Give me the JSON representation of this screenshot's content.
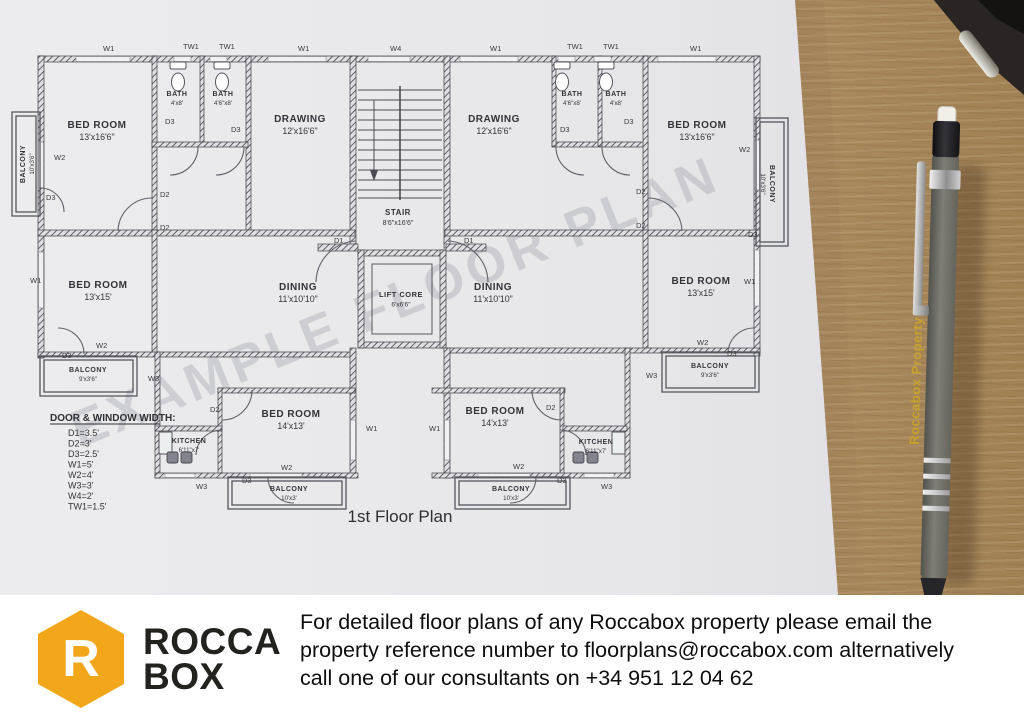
{
  "photo": {
    "watermark": "EXAMPLE FLOOR PLAN",
    "pen_text": "Roccabox Property"
  },
  "plan": {
    "title": "1st Floor Plan",
    "legend": {
      "heading": "DOOR & WINDOW WIDTH:",
      "items": [
        "D1=3.5'",
        "D2=3'",
        "D3=2.5'",
        "W1=5'",
        "W2=4'",
        "W3=3'",
        "W4=2'",
        "TW1=1.5'"
      ]
    },
    "rooms": [
      {
        "name": "BED ROOM",
        "dims": "13'x16'6\"",
        "x": 97,
        "y": 128,
        "fs": 10
      },
      {
        "name": "BATH",
        "dims": "4'x8'",
        "x": 177,
        "y": 96,
        "fs": 7
      },
      {
        "name": "BATH",
        "dims": "4'6\"x8'",
        "x": 223,
        "y": 96,
        "fs": 7
      },
      {
        "name": "DRAWING",
        "dims": "12'x16'6\"",
        "x": 300,
        "y": 122,
        "fs": 10
      },
      {
        "name": "STAIR",
        "dims": "8'6\"x16'6\"",
        "x": 398,
        "y": 215,
        "fs": 8
      },
      {
        "name": "DRAWING",
        "dims": "12'x16'6\"",
        "x": 494,
        "y": 122,
        "fs": 10
      },
      {
        "name": "BATH",
        "dims": "4'6\"x8'",
        "x": 572,
        "y": 96,
        "fs": 7
      },
      {
        "name": "BATH",
        "dims": "4'x8'",
        "x": 616,
        "y": 96,
        "fs": 7
      },
      {
        "name": "BED ROOM",
        "dims": "13'x16'6\"",
        "x": 697,
        "y": 128,
        "fs": 10
      },
      {
        "name": "BALCONY",
        "dims": "10'x3'6\"",
        "x": 25,
        "y": 164,
        "fs": 7,
        "rot": -90
      },
      {
        "name": "BALCONY",
        "dims": "10'x3'6\"",
        "x": 770,
        "y": 184,
        "fs": 7,
        "rot": 90
      },
      {
        "name": "BED ROOM",
        "dims": "13'x15'",
        "x": 98,
        "y": 288,
        "fs": 10
      },
      {
        "name": "DINING",
        "dims": "11'x10'10\"",
        "x": 298,
        "y": 290,
        "fs": 10
      },
      {
        "name": "LIFT CORE",
        "dims": "6'x6'6\"",
        "x": 401,
        "y": 297,
        "fs": 7.5
      },
      {
        "name": "DINING",
        "dims": "11'x10'10\"",
        "x": 493,
        "y": 290,
        "fs": 10
      },
      {
        "name": "BED ROOM",
        "dims": "13'x15'",
        "x": 701,
        "y": 284,
        "fs": 10
      },
      {
        "name": "BALCONY",
        "dims": "9'x3'6\"",
        "x": 88,
        "y": 372,
        "fs": 7
      },
      {
        "name": "BALCONY",
        "dims": "9'x3'6\"",
        "x": 710,
        "y": 368,
        "fs": 7
      },
      {
        "name": "KITCHEN",
        "dims": "6'11\"x7'",
        "x": 189,
        "y": 443,
        "fs": 7
      },
      {
        "name": "BED ROOM",
        "dims": "14'x13'",
        "x": 291,
        "y": 417,
        "fs": 10
      },
      {
        "name": "BED ROOM",
        "dims": "14'x13'",
        "x": 495,
        "y": 414,
        "fs": 10
      },
      {
        "name": "KITCHEN",
        "dims": "6'11\"x7'",
        "x": 596,
        "y": 444,
        "fs": 7
      },
      {
        "name": "BALCONY",
        "dims": "10'x3'",
        "x": 289,
        "y": 491,
        "fs": 7
      },
      {
        "name": "BALCONY",
        "dims": "10'x3'",
        "x": 511,
        "y": 491,
        "fs": 7
      }
    ],
    "wall_tags": [
      {
        "t": "W1",
        "x": 103,
        "y": 51
      },
      {
        "t": "TW1",
        "x": 183,
        "y": 49
      },
      {
        "t": "TW1",
        "x": 219,
        "y": 49
      },
      {
        "t": "W1",
        "x": 298,
        "y": 51
      },
      {
        "t": "W4",
        "x": 390,
        "y": 51
      },
      {
        "t": "W1",
        "x": 490,
        "y": 51
      },
      {
        "t": "TW1",
        "x": 567,
        "y": 49
      },
      {
        "t": "TW1",
        "x": 603,
        "y": 49
      },
      {
        "t": "W1",
        "x": 690,
        "y": 51
      },
      {
        "t": "W2",
        "x": 54,
        "y": 160
      },
      {
        "t": "D3",
        "x": 46,
        "y": 200
      },
      {
        "t": "W1",
        "x": 30,
        "y": 283
      },
      {
        "t": "W2",
        "x": 739,
        "y": 152
      },
      {
        "t": "D3",
        "x": 748,
        "y": 237
      },
      {
        "t": "W1",
        "x": 744,
        "y": 284
      },
      {
        "t": "D3",
        "x": 165,
        "y": 124
      },
      {
        "t": "D3",
        "x": 231,
        "y": 132
      },
      {
        "t": "D3",
        "x": 560,
        "y": 132
      },
      {
        "t": "D3",
        "x": 624,
        "y": 124
      },
      {
        "t": "D2",
        "x": 160,
        "y": 197
      },
      {
        "t": "D2",
        "x": 160,
        "y": 230
      },
      {
        "t": "D2",
        "x": 636,
        "y": 194
      },
      {
        "t": "D2",
        "x": 636,
        "y": 228
      },
      {
        "t": "D1",
        "x": 334,
        "y": 243
      },
      {
        "t": "D1",
        "x": 464,
        "y": 243
      },
      {
        "t": "W2",
        "x": 96,
        "y": 348
      },
      {
        "t": "D3",
        "x": 62,
        "y": 358
      },
      {
        "t": "W3",
        "x": 148,
        "y": 381
      },
      {
        "t": "W2",
        "x": 697,
        "y": 345
      },
      {
        "t": "D3",
        "x": 727,
        "y": 356
      },
      {
        "t": "W3",
        "x": 646,
        "y": 378
      },
      {
        "t": "D2",
        "x": 210,
        "y": 412
      },
      {
        "t": "D2",
        "x": 546,
        "y": 410
      },
      {
        "t": "W1",
        "x": 366,
        "y": 431
      },
      {
        "t": "W1",
        "x": 429,
        "y": 431
      },
      {
        "t": "W2",
        "x": 281,
        "y": 470
      },
      {
        "t": "D3",
        "x": 242,
        "y": 483
      },
      {
        "t": "W3",
        "x": 196,
        "y": 489
      },
      {
        "t": "W2",
        "x": 513,
        "y": 469
      },
      {
        "t": "D3",
        "x": 557,
        "y": 483
      },
      {
        "t": "W3",
        "x": 601,
        "y": 489
      }
    ]
  },
  "footer": {
    "logo_letter": "R",
    "logo_line1": "ROCCA",
    "logo_line2": "BOX",
    "brand_color": "#F2A71B",
    "lines": [
      "For detailed floor plans of any Roccabox property please email the",
      "property reference number to floorplans@roccabox.com alternatively",
      "call one of our consultants on +34 951 12 04 62"
    ]
  },
  "colors": {
    "brand": "#F2A71B",
    "paper": "#e8e8ec",
    "wood": "#9a7b52",
    "ink": "#3c3c44"
  }
}
